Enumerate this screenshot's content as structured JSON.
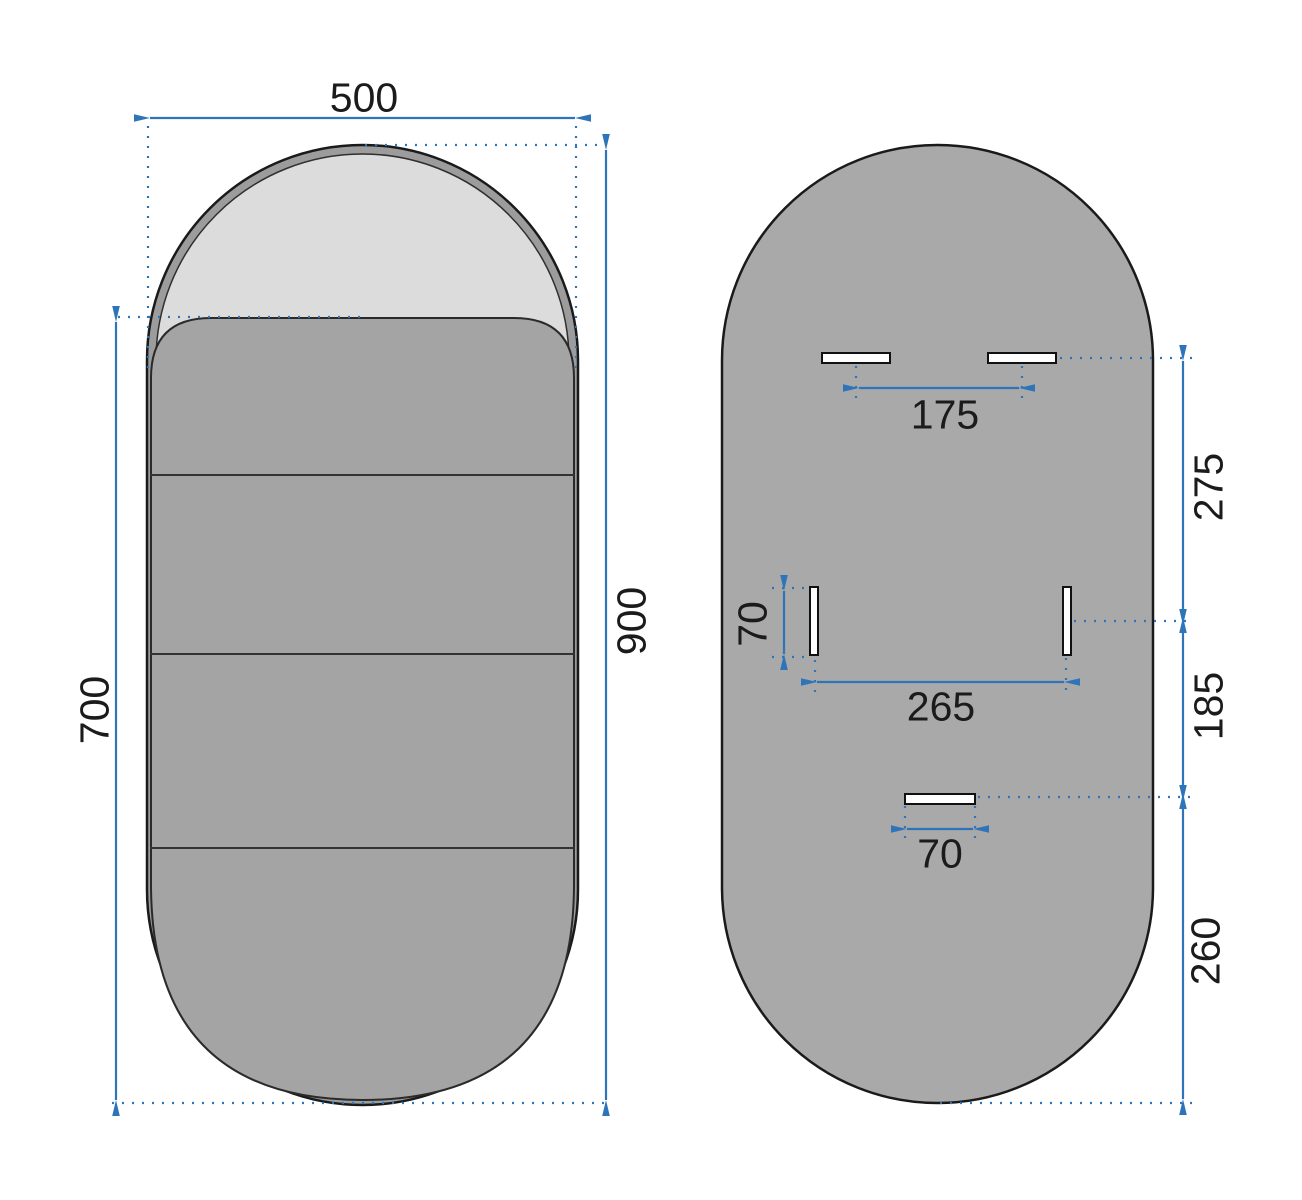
{
  "drawing": {
    "description": "Technical dimension drawing of an oval pill-shaped mirror, front view and back view",
    "front_view": {
      "width_label": "500",
      "total_height_label": "900",
      "panel_height_label": "700"
    },
    "back_view": {
      "top_slots_spacing_label": "175",
      "top_to_side_offset_label": "275",
      "side_slot_length_label": "70",
      "side_slots_spacing_label": "265",
      "side_to_bottom_offset_label": "185",
      "bottom_slot_width_label": "70",
      "bottom_offset_label": "260"
    },
    "colors": {
      "dimension_blue": "#2e74b8",
      "outline_black": "#1a1a1a",
      "back_body_gray": "#a9a9a9",
      "panel_gray": "#a4a4a4",
      "frame_ring_gray": "#9c9c9c",
      "glass_gray": "#dcdcdc",
      "slot_white": "#ffffff"
    }
  }
}
